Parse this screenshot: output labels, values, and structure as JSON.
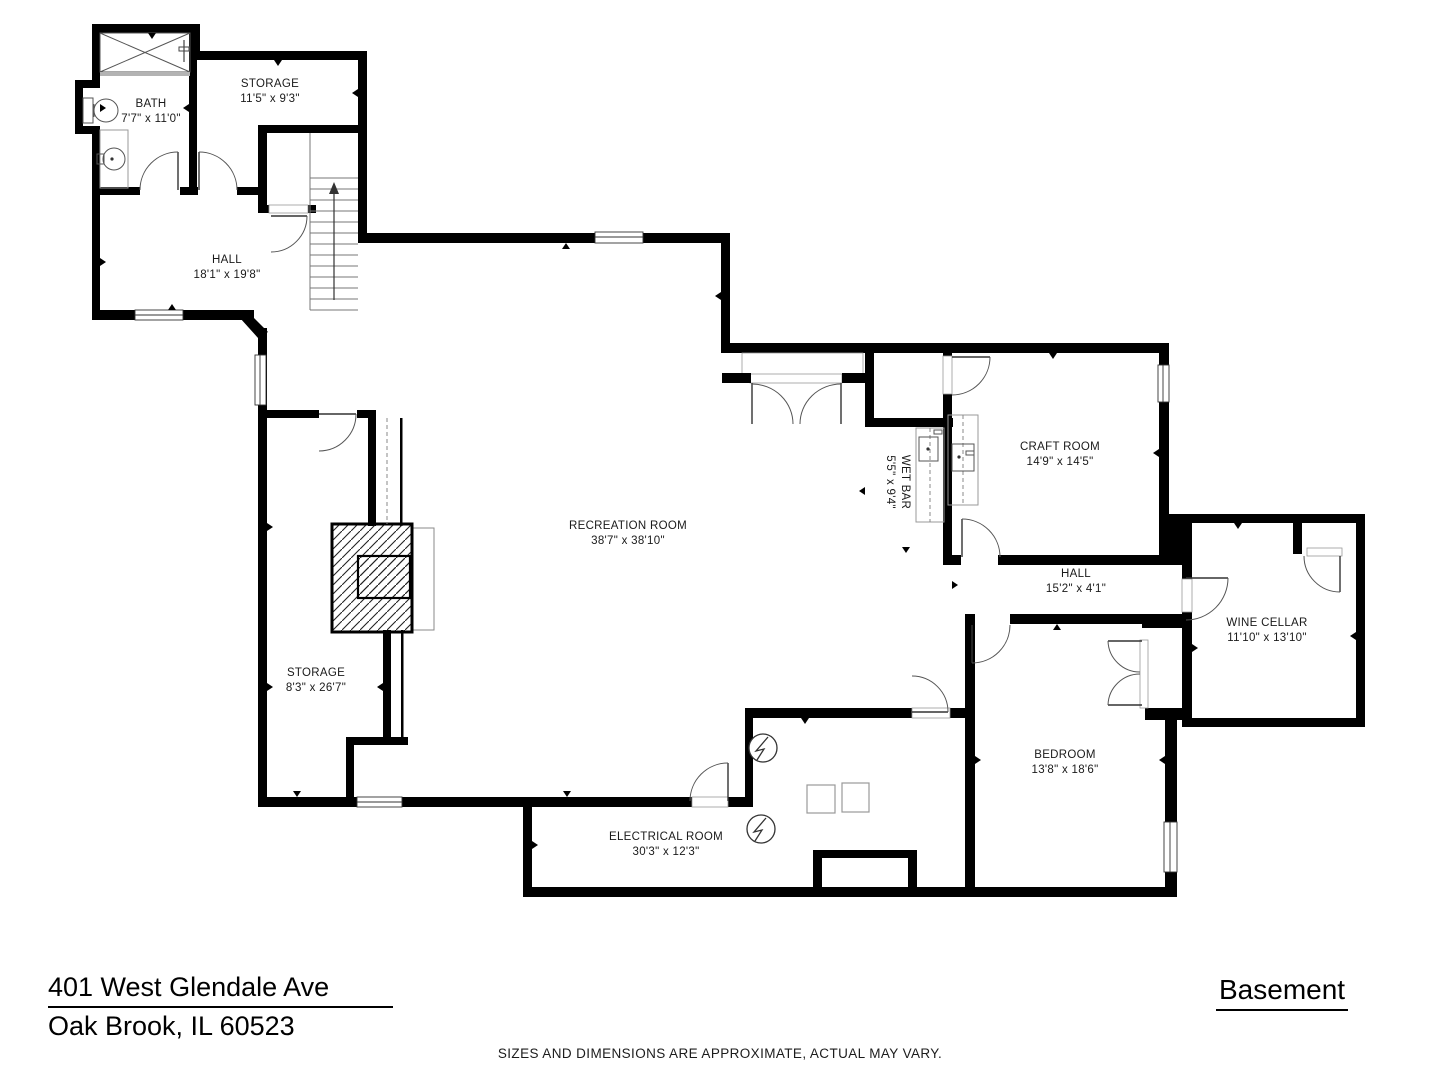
{
  "footer": {
    "address_line1": "401 West Glendale Ave",
    "address_line2": "Oak Brook, IL 60523",
    "floor_label": "Basement",
    "disclaimer": "SIZES AND DIMENSIONS ARE APPROXIMATE, ACTUAL MAY VARY."
  },
  "rooms": [
    {
      "id": "bath",
      "name": "BATH",
      "dims": "7'7\" x 11'0\""
    },
    {
      "id": "storage-upper",
      "name": "STORAGE",
      "dims": "11'5\" x 9'3\""
    },
    {
      "id": "hall-main",
      "name": "HALL",
      "dims": "18'1\" x 19'8\""
    },
    {
      "id": "recreation",
      "name": "RECREATION ROOM",
      "dims": "38'7\" x 38'10\""
    },
    {
      "id": "wet-bar",
      "name": "WET BAR",
      "dims": "5'5\" x 9'4\""
    },
    {
      "id": "craft-room",
      "name": "CRAFT ROOM",
      "dims": "14'9\" x 14'5\""
    },
    {
      "id": "hall-small",
      "name": "HALL",
      "dims": "15'2\" x 4'1\""
    },
    {
      "id": "wine-cellar",
      "name": "WINE CELLAR",
      "dims": "11'10\" x 13'10\""
    },
    {
      "id": "storage-lower",
      "name": "STORAGE",
      "dims": "8'3\" x 26'7\""
    },
    {
      "id": "bedroom",
      "name": "BEDROOM",
      "dims": "13'8\" x 18'6\""
    },
    {
      "id": "electrical",
      "name": "ELECTRICAL ROOM",
      "dims": "30'3\" x 12'3\""
    }
  ],
  "colors": {
    "wall": "#000000",
    "text": "#1a1a1a",
    "fixture": "#8a8a8a",
    "door_arc": "#555555"
  }
}
